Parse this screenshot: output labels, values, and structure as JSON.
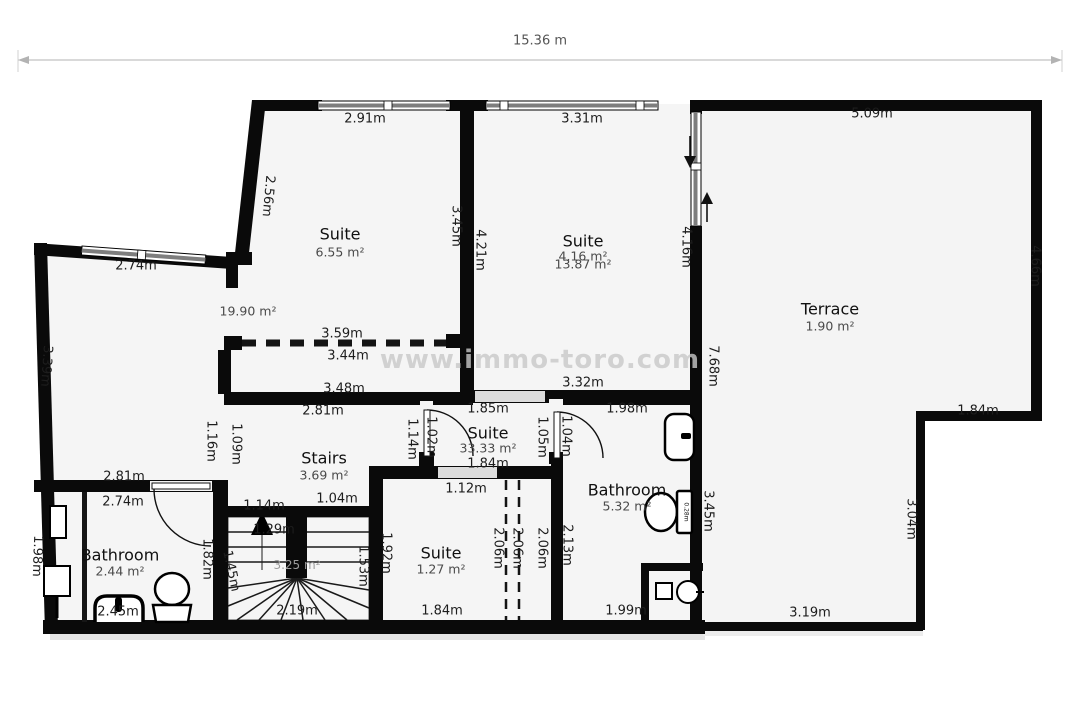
{
  "scale_bar": {
    "label": "15.36 m",
    "x": 540,
    "y": 41
  },
  "watermark": {
    "text": "www.immo-toro.com",
    "x": 540,
    "y": 360
  },
  "colors": {
    "wall": "#0a0a0a",
    "floor": "#f5f5f5",
    "window_bar": "#8a8a8a"
  },
  "rooms": [
    {
      "name": "Suite",
      "area": "6.55 m²",
      "nx": 340,
      "ny": 234,
      "ax": 340,
      "ay": 252
    },
    {
      "name": "Suite",
      "area": "4.16 m²",
      "nx": 583,
      "ny": 241,
      "ax": 583,
      "ay": 256,
      "area2": "13.87 m²",
      "a2x": 583,
      "a2y": 264
    },
    {
      "name": "Terrace",
      "area": "1.90 m²",
      "nx": 830,
      "ny": 309,
      "ax": 830,
      "ay": 326
    },
    {
      "name": "Stairs",
      "area": "3.69 m²",
      "nx": 324,
      "ny": 458,
      "ax": 324,
      "ay": 475
    },
    {
      "name": "Suite",
      "area": "33.33 m²",
      "nx": 488,
      "ny": 433,
      "ax": 488,
      "ay": 448
    },
    {
      "name": "Bathroom",
      "area": "5.32 m²",
      "nx": 627,
      "ny": 490,
      "ax": 627,
      "ay": 506
    },
    {
      "name": "Bathroom",
      "area": "2.44 m²",
      "nx": 120,
      "ny": 555,
      "ax": 120,
      "ay": 571
    },
    {
      "name": "Suite",
      "area": "1.27 m²",
      "nx": 441,
      "ny": 553,
      "ax": 441,
      "ay": 569
    }
  ],
  "extra_area_labels": [
    {
      "t": "19.90 m²",
      "x": 248,
      "y": 311,
      "c": "area"
    },
    {
      "t": "3.25 m²",
      "x": 297,
      "y": 565,
      "c": "area-light"
    }
  ],
  "dimension_labels": [
    {
      "t": "2.91m",
      "x": 365,
      "y": 119
    },
    {
      "t": "3.31m",
      "x": 582,
      "y": 119
    },
    {
      "t": "5.09m",
      "x": 872,
      "y": 114
    },
    {
      "t": "2.74m",
      "x": 136,
      "y": 266
    },
    {
      "t": "3.59m",
      "x": 342,
      "y": 334
    },
    {
      "t": "3.44m",
      "x": 348,
      "y": 356
    },
    {
      "t": "3.48m",
      "x": 344,
      "y": 389
    },
    {
      "t": "3.32m",
      "x": 583,
      "y": 383
    },
    {
      "t": "2.81m",
      "x": 323,
      "y": 411
    },
    {
      "t": "1.85m",
      "x": 488,
      "y": 409
    },
    {
      "t": "1.98m",
      "x": 627,
      "y": 409
    },
    {
      "t": "1.84m",
      "x": 978,
      "y": 411
    },
    {
      "t": "1.84m",
      "x": 488,
      "y": 464
    },
    {
      "t": "1.12m",
      "x": 466,
      "y": 489
    },
    {
      "t": "2.81m",
      "x": 124,
      "y": 477
    },
    {
      "t": "2.74m",
      "x": 123,
      "y": 502
    },
    {
      "t": "1.14m",
      "x": 264,
      "y": 506
    },
    {
      "t": "1.04m",
      "x": 337,
      "y": 499
    },
    {
      "t": "1.29m",
      "x": 274,
      "y": 530
    },
    {
      "t": "1.84m",
      "x": 442,
      "y": 611
    },
    {
      "t": "2.19m",
      "x": 297,
      "y": 611
    },
    {
      "t": "1.99m",
      "x": 626,
      "y": 611
    },
    {
      "t": "3.19m",
      "x": 810,
      "y": 613
    },
    {
      "t": "2.45m",
      "x": 118,
      "y": 612
    },
    {
      "t": "2.56m",
      "x": 268,
      "y": 196,
      "r": 95
    },
    {
      "t": "3.45m",
      "x": 456,
      "y": 226,
      "r": 90
    },
    {
      "t": "4.21m",
      "x": 480,
      "y": 250,
      "r": 90
    },
    {
      "t": "4.16m",
      "x": 686,
      "y": 247,
      "r": 90
    },
    {
      "t": "4.66m",
      "x": 1035,
      "y": 266,
      "r": 90
    },
    {
      "t": "3.39m",
      "x": 46,
      "y": 366,
      "r": 94
    },
    {
      "t": "7.68m",
      "x": 713,
      "y": 366,
      "r": 90
    },
    {
      "t": "1.16m",
      "x": 211,
      "y": 441,
      "r": 90
    },
    {
      "t": "1.09m",
      "x": 236,
      "y": 444,
      "r": 90
    },
    {
      "t": "1.14m",
      "x": 412,
      "y": 439,
      "r": 90
    },
    {
      "t": "1.02m",
      "x": 431,
      "y": 437,
      "r": 90
    },
    {
      "t": "1.05m",
      "x": 542,
      "y": 437,
      "r": 90
    },
    {
      "t": "1.04m",
      "x": 566,
      "y": 436,
      "r": 90
    },
    {
      "t": "3.45m",
      "x": 708,
      "y": 511,
      "r": 90
    },
    {
      "t": "1.98m",
      "x": 37,
      "y": 556,
      "r": 92
    },
    {
      "t": "1.82m",
      "x": 207,
      "y": 559,
      "r": 90
    },
    {
      "t": "1.45m",
      "x": 231,
      "y": 571,
      "r": 78
    },
    {
      "t": "1.53m",
      "x": 363,
      "y": 566,
      "r": 90
    },
    {
      "t": "1.92m",
      "x": 386,
      "y": 553,
      "r": 90
    },
    {
      "t": "2.06m",
      "x": 498,
      "y": 548,
      "r": 90
    },
    {
      "t": "2.06m",
      "x": 517,
      "y": 548,
      "r": 90
    },
    {
      "t": "2.06m",
      "x": 542,
      "y": 548,
      "r": 90
    },
    {
      "t": "2.13m",
      "x": 567,
      "y": 545,
      "r": 90
    },
    {
      "t": "3.04m",
      "x": 911,
      "y": 519,
      "r": 90
    },
    {
      "t": "0.28m",
      "x": 686,
      "y": 512,
      "r": 90,
      "c": "tiny"
    }
  ]
}
